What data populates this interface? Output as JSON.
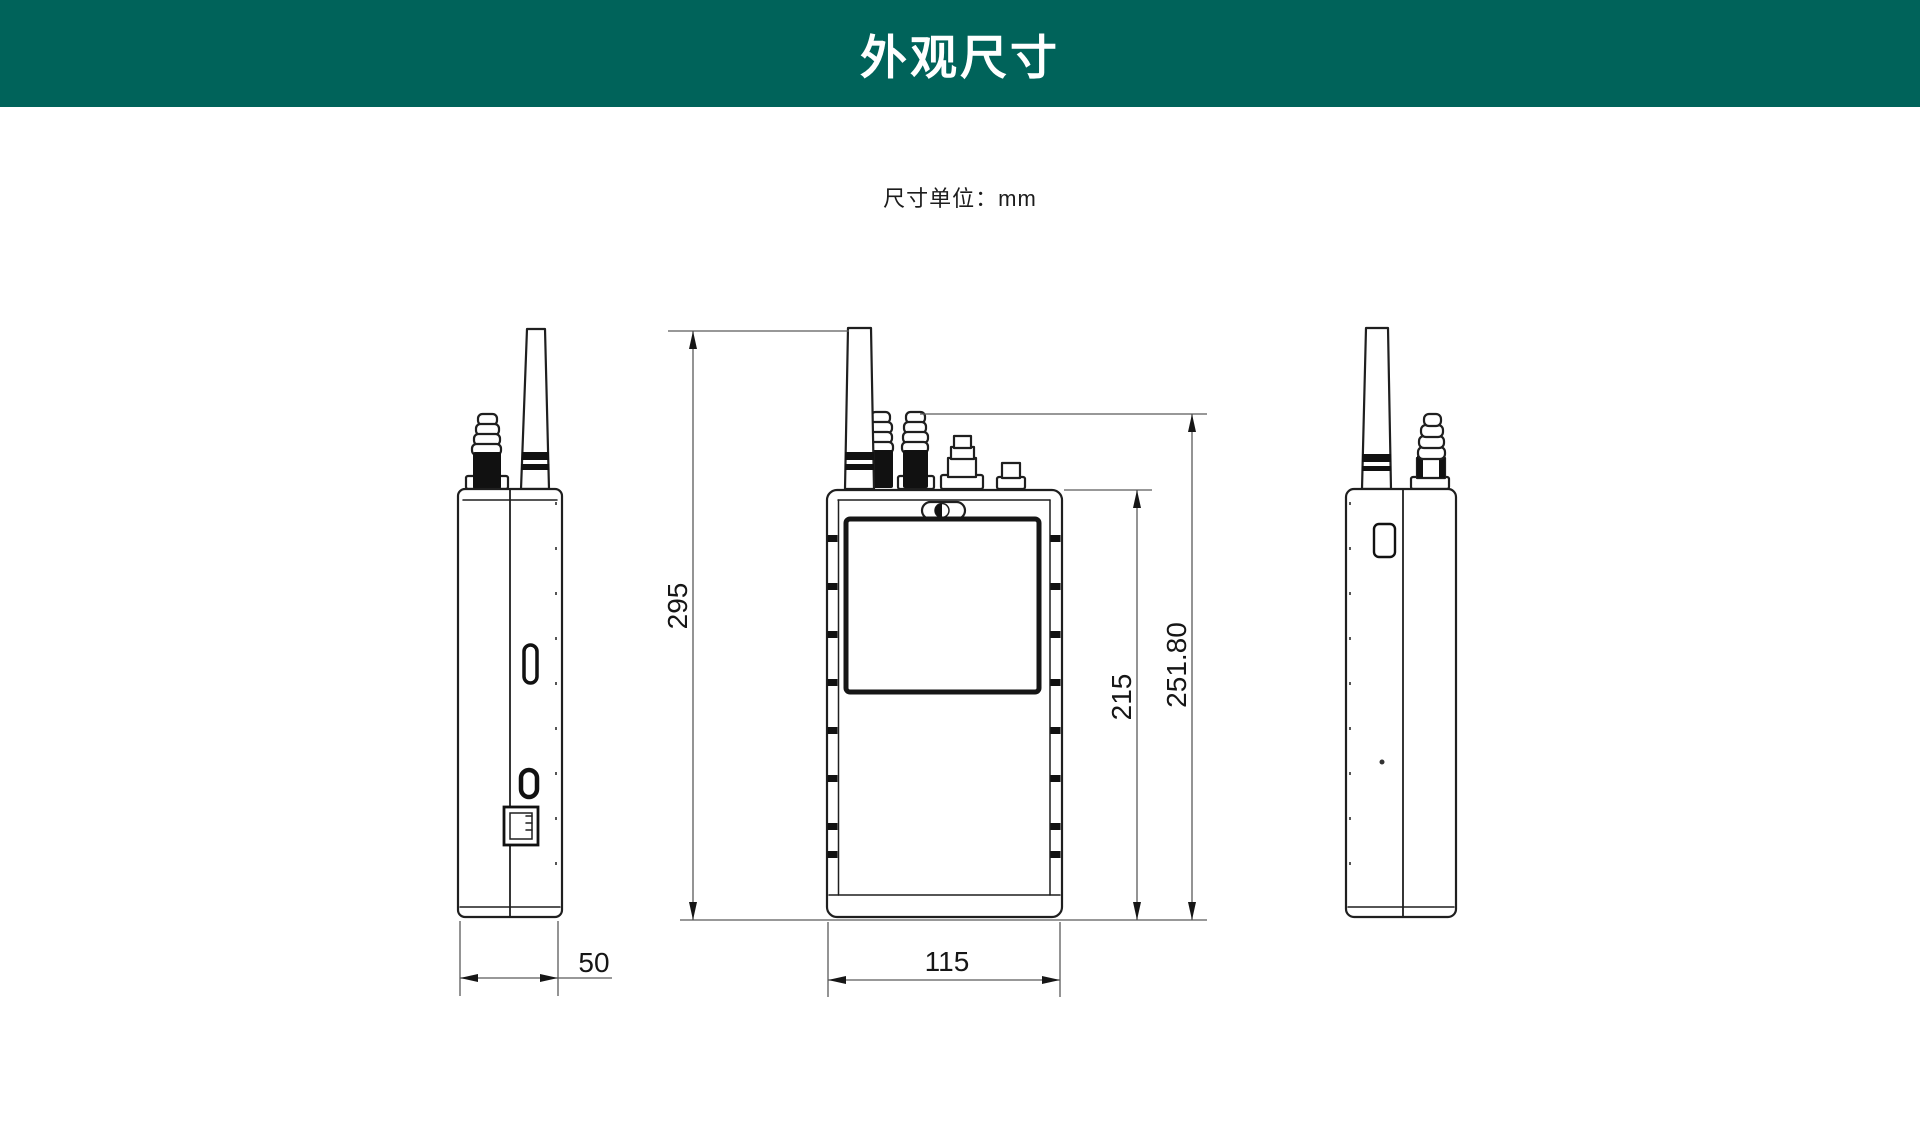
{
  "header": {
    "title": "外观尺寸"
  },
  "note": {
    "unit_label": "尺寸单位：mm"
  },
  "dimensions": {
    "overall_height": "295",
    "depth": "50",
    "width": "115",
    "body_height": "215",
    "height_with_connector": "251.80"
  },
  "colors": {
    "header_bg": "#00635a",
    "header_text": "#ffffff",
    "outline": "#1f1f1f",
    "dim_line": "#5a5a5a",
    "dim_text": "#161616",
    "fill_dark": "#111111",
    "page_bg": "#ffffff"
  }
}
